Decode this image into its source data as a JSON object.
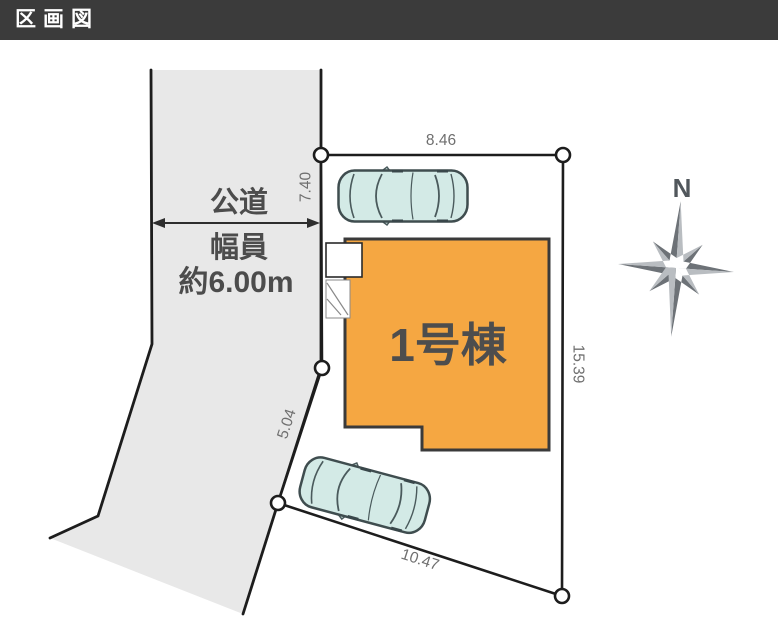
{
  "header": {
    "title": "区画図"
  },
  "road": {
    "label_line1": "公道",
    "label_line2": "幅員",
    "label_line3": "約6.00m"
  },
  "plot": {
    "dimensions": {
      "top": "8.46",
      "upper_left": "7.40",
      "lower_left": "5.04",
      "right": "15.39",
      "bottom": "10.47"
    }
  },
  "building": {
    "label": "1号棟"
  },
  "compass": {
    "label": "N"
  },
  "colors": {
    "header_bg": "#3b3b3b",
    "road_fill": "#e8e8e8",
    "plot_fill": "#ffffff",
    "building_fill": "#f5a742",
    "car_fill": "#d3eae6",
    "outline": "#1d1d1d"
  }
}
